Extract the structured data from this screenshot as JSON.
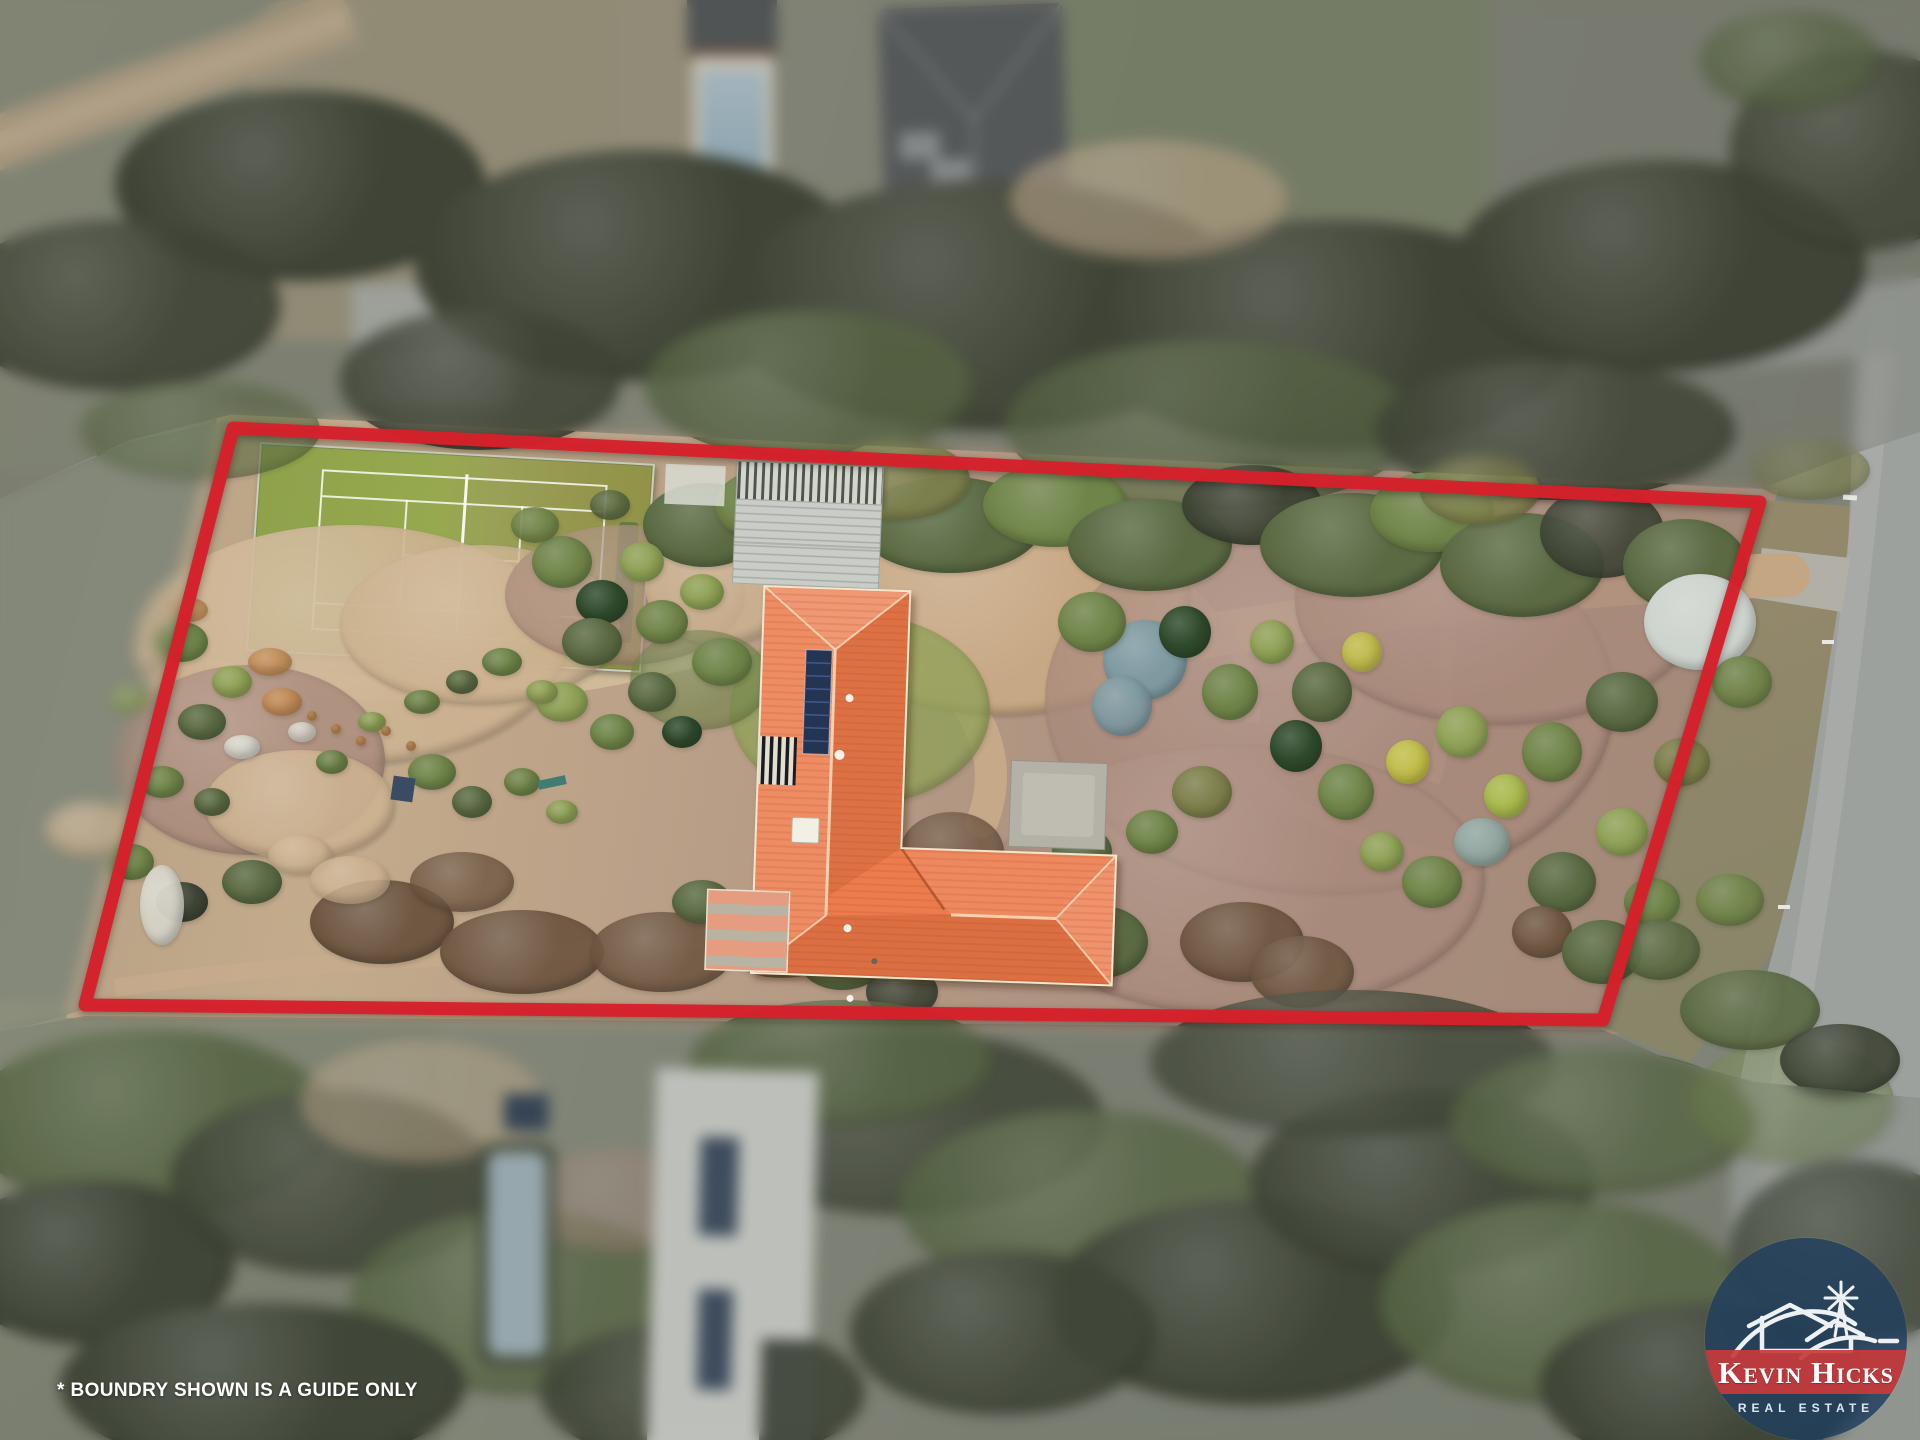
{
  "watermark": {
    "disclaimer": "* BOUNDRY SHOWN IS A GUIDE ONLY"
  },
  "logo": {
    "brand_top": "Kevin Hicks",
    "brand_bottom": "REAL ESTATE",
    "circle_color": "rgba(32,62,94,0.83)",
    "band_color": "rgba(200,58,60,0.92)"
  },
  "boundary": {
    "color": "#d6202a",
    "stroke_width": 13,
    "points": [
      [
        233,
        428
      ],
      [
        1760,
        502
      ],
      [
        1603,
        1020
      ],
      [
        85,
        1005
      ]
    ]
  },
  "scene": {
    "palette": [
      "#3f4536",
      "#5a6a43",
      "#6f8449",
      "#8fa156",
      "#7d7f4c",
      "#92a69f",
      "#7e99a0",
      "#c2bd4a",
      "#a9b94e",
      "#6f5742",
      "#cdb391",
      "#a98a7c",
      "#d6d3c8",
      "#c28a52",
      "#cdd3cd",
      "#2f4a2c",
      "#c7a884",
      "#b7bbb3"
    ],
    "blobs": [
      [
        350,
        645,
        215,
        120,
        10,
        0.9
      ],
      [
        250,
        760,
        135,
        95,
        11,
        0.8
      ],
      [
        300,
        805,
        95,
        55,
        10,
        0.9
      ],
      [
        480,
        625,
        140,
        80,
        10,
        0.8
      ],
      [
        625,
        595,
        120,
        70,
        11,
        0.7
      ],
      [
        720,
        585,
        75,
        60,
        10,
        0.85
      ],
      [
        1000,
        600,
        190,
        115,
        16,
        1
      ],
      [
        1330,
        700,
        285,
        195,
        11,
        0.75
      ],
      [
        1500,
        600,
        205,
        125,
        11,
        0.7
      ],
      [
        1240,
        880,
        245,
        135,
        11,
        0.7
      ],
      [
        860,
        710,
        130,
        95,
        3,
        0.75
      ],
      [
        700,
        680,
        70,
        50,
        2,
        0.6
      ],
      [
        90,
        830,
        45,
        28,
        10,
        0.85
      ],
      [
        300,
        855,
        32,
        20,
        10,
        0.9
      ],
      [
        300,
        185,
        185,
        95,
        0,
        1
      ],
      [
        640,
        265,
        225,
        115,
        0,
        1
      ],
      [
        990,
        305,
        265,
        125,
        0,
        1
      ],
      [
        1330,
        335,
        245,
        115,
        0,
        1
      ],
      [
        1660,
        265,
        205,
        105,
        0,
        1
      ],
      [
        115,
        305,
        165,
        85,
        0,
        0.9
      ],
      [
        810,
        385,
        165,
        75,
        1,
        0.8
      ],
      [
        1210,
        425,
        205,
        85,
        1,
        0.7
      ],
      [
        1555,
        430,
        180,
        70,
        0,
        0.85
      ],
      [
        480,
        380,
        140,
        70,
        0,
        0.85
      ],
      [
        200,
        430,
        120,
        50,
        1,
        0.6
      ],
      [
        1150,
        200,
        140,
        60,
        10,
        0.6
      ],
      [
        1860,
        150,
        130,
        100,
        0,
        0.85
      ],
      [
        1790,
        60,
        90,
        50,
        1,
        0.7
      ],
      [
        705,
        525,
        62,
        42,
        1,
        1
      ],
      [
        765,
        505,
        50,
        35,
        2,
        1
      ],
      [
        950,
        525,
        92,
        48,
        1,
        1
      ],
      [
        1055,
        505,
        72,
        42,
        2,
        1
      ],
      [
        1150,
        545,
        82,
        46,
        1,
        1
      ],
      [
        1252,
        505,
        70,
        40,
        0,
        0.95
      ],
      [
        1352,
        545,
        92,
        52,
        1,
        1
      ],
      [
        1432,
        512,
        62,
        40,
        2,
        1
      ],
      [
        1522,
        565,
        82,
        52,
        1,
        1
      ],
      [
        1602,
        532,
        62,
        46,
        0,
        0.9
      ],
      [
        1685,
        565,
        62,
        46,
        1,
        1
      ],
      [
        900,
        480,
        70,
        40,
        4,
        0.9
      ],
      [
        1480,
        490,
        60,
        35,
        4,
        0.85
      ],
      [
        1145,
        660,
        42,
        40,
        6,
        1
      ],
      [
        1122,
        706,
        30,
        30,
        6,
        0.95
      ],
      [
        1185,
        632,
        26,
        26,
        15,
        1
      ],
      [
        1092,
        622,
        34,
        30,
        2,
        1
      ],
      [
        1230,
        692,
        28,
        28,
        2,
        1
      ],
      [
        1272,
        642,
        22,
        22,
        3,
        1
      ],
      [
        1322,
        692,
        30,
        30,
        1,
        1
      ],
      [
        1362,
        652,
        20,
        20,
        7,
        0.95
      ],
      [
        1296,
        746,
        26,
        26,
        15,
        1
      ],
      [
        1346,
        792,
        28,
        28,
        2,
        1
      ],
      [
        1408,
        762,
        22,
        22,
        7,
        1
      ],
      [
        1462,
        732,
        26,
        26,
        3,
        1
      ],
      [
        1506,
        796,
        22,
        22,
        8,
        1
      ],
      [
        1552,
        752,
        30,
        30,
        2,
        1
      ],
      [
        1482,
        842,
        28,
        24,
        5,
        1
      ],
      [
        1432,
        882,
        30,
        26,
        2,
        1
      ],
      [
        1382,
        852,
        22,
        20,
        3,
        1
      ],
      [
        1562,
        882,
        34,
        30,
        1,
        1
      ],
      [
        1622,
        832,
        26,
        24,
        3,
        1
      ],
      [
        1542,
        932,
        30,
        26,
        9,
        0.95
      ],
      [
        1602,
        952,
        40,
        32,
        1,
        1
      ],
      [
        1652,
        902,
        28,
        24,
        2,
        1
      ],
      [
        1700,
        622,
        56,
        48,
        14,
        1
      ],
      [
        1742,
        682,
        30,
        26,
        2,
        0.95
      ],
      [
        1622,
        702,
        36,
        30,
        1,
        1
      ],
      [
        1682,
        762,
        28,
        24,
        4,
        1
      ],
      [
        1202,
        792,
        30,
        26,
        4,
        1
      ],
      [
        1152,
        832,
        26,
        22,
        2,
        1
      ],
      [
        1082,
        852,
        30,
        26,
        1,
        1
      ],
      [
        1242,
        942,
        62,
        40,
        9,
        0.95
      ],
      [
        1302,
        972,
        52,
        36,
        9,
        0.9
      ],
      [
        1102,
        942,
        46,
        36,
        1,
        1
      ],
      [
        1002,
        902,
        62,
        46,
        9,
        0.85
      ],
      [
        952,
        852,
        52,
        40,
        9,
        0.8
      ],
      [
        1660,
        950,
        40,
        30,
        1,
        0.9
      ],
      [
        1730,
        900,
        34,
        26,
        2,
        0.9
      ],
      [
        562,
        562,
        30,
        26,
        2,
        1
      ],
      [
        602,
        602,
        26,
        22,
        15,
        1
      ],
      [
        642,
        562,
        22,
        20,
        3,
        1
      ],
      [
        592,
        642,
        30,
        24,
        1,
        1
      ],
      [
        662,
        622,
        26,
        22,
        2,
        1
      ],
      [
        702,
        592,
        22,
        18,
        3,
        1
      ],
      [
        722,
        662,
        30,
        24,
        2,
        1
      ],
      [
        652,
        692,
        24,
        20,
        1,
        1
      ],
      [
        562,
        702,
        26,
        20,
        3,
        1
      ],
      [
        612,
        732,
        22,
        18,
        2,
        1
      ],
      [
        682,
        732,
        20,
        16,
        15,
        1
      ],
      [
        535,
        525,
        24,
        18,
        2,
        0.9
      ],
      [
        610,
        505,
        20,
        15,
        1,
        0.9
      ],
      [
        182,
        642,
        26,
        20,
        2,
        1
      ],
      [
        232,
        682,
        20,
        16,
        3,
        1
      ],
      [
        202,
        722,
        24,
        18,
        1,
        1
      ],
      [
        282,
        702,
        20,
        14,
        13,
        0.9
      ],
      [
        270,
        662,
        22,
        14,
        13,
        0.85
      ],
      [
        190,
        610,
        18,
        12,
        13,
        0.8
      ],
      [
        242,
        747,
        18,
        12,
        12,
        1
      ],
      [
        302,
        732,
        14,
        10,
        12,
        0.95
      ],
      [
        162,
        782,
        22,
        16,
        2,
        1
      ],
      [
        212,
        802,
        18,
        14,
        1,
        1
      ],
      [
        332,
        762,
        16,
        12,
        2,
        1
      ],
      [
        372,
        722,
        14,
        10,
        3,
        1
      ],
      [
        422,
        702,
        18,
        12,
        2,
        1
      ],
      [
        462,
        682,
        16,
        12,
        1,
        1
      ],
      [
        502,
        662,
        20,
        14,
        2,
        1
      ],
      [
        542,
        692,
        16,
        12,
        3,
        1
      ],
      [
        312,
        716,
        5,
        5,
        13,
        1
      ],
      [
        336,
        729,
        5,
        5,
        13,
        1
      ],
      [
        361,
        741,
        5,
        5,
        13,
        1
      ],
      [
        386,
        731,
        5,
        5,
        13,
        1
      ],
      [
        411,
        746,
        5,
        5,
        13,
        1
      ],
      [
        432,
        772,
        24,
        18,
        2,
        1
      ],
      [
        472,
        802,
        20,
        16,
        1,
        1
      ],
      [
        522,
        782,
        18,
        14,
        2,
        1
      ],
      [
        562,
        812,
        16,
        12,
        3,
        1
      ],
      [
        130,
        700,
        20,
        14,
        3,
        0.8
      ],
      [
        150,
        660,
        16,
        10,
        10,
        0.9
      ],
      [
        382,
        922,
        72,
        42,
        9,
        1
      ],
      [
        522,
        952,
        82,
        42,
        9,
        0.95
      ],
      [
        662,
        952,
        72,
        40,
        9,
        0.9
      ],
      [
        782,
        942,
        62,
        36,
        9,
        0.85
      ],
      [
        462,
        882,
        52,
        30,
        9,
        0.8
      ],
      [
        252,
        882,
        30,
        22,
        1,
        1
      ],
      [
        182,
        902,
        26,
        20,
        0,
        1
      ],
      [
        132,
        862,
        22,
        18,
        2,
        1
      ],
      [
        702,
        902,
        30,
        22,
        1,
        1
      ],
      [
        842,
        962,
        42,
        28,
        1,
        1
      ],
      [
        902,
        992,
        36,
        26,
        0,
        0.9
      ],
      [
        162,
        905,
        22,
        40,
        12,
        0.95
      ],
      [
        350,
        880,
        40,
        24,
        10,
        0.8
      ],
      [
        152,
        1122,
        182,
        92,
        1,
        0.9
      ],
      [
        92,
        1262,
        142,
        82,
        0,
        1
      ],
      [
        332,
        1182,
        162,
        92,
        0,
        0.85
      ],
      [
        522,
        1302,
        172,
        92,
        1,
        0.8
      ],
      [
        262,
        1385,
        202,
        82,
        0,
        1
      ],
      [
        702,
        1392,
        162,
        72,
        0,
        0.9
      ],
      [
        902,
        1122,
        202,
        92,
        0,
        0.85
      ],
      [
        1082,
        1202,
        182,
        92,
        1,
        0.8
      ],
      [
        1252,
        1302,
        202,
        102,
        0,
        1
      ],
      [
        1422,
        1182,
        172,
        92,
        0,
        0.9
      ],
      [
        1562,
        1302,
        182,
        102,
        1,
        0.85
      ],
      [
        1702,
        1385,
        162,
        82,
        0,
        1
      ],
      [
        1852,
        1252,
        122,
        92,
        0,
        0.8
      ],
      [
        1002,
        1332,
        152,
        82,
        0,
        0.9
      ],
      [
        842,
        1062,
        152,
        62,
        1,
        0.8
      ],
      [
        1352,
        1062,
        202,
        72,
        0,
        0.75
      ],
      [
        1602,
        1122,
        152,
        72,
        1,
        0.8
      ],
      [
        422,
        1102,
        122,
        62,
        10,
        0.5
      ],
      [
        622,
        1202,
        102,
        52,
        11,
        0.5
      ],
      [
        1792,
        1102,
        102,
        62,
        2,
        0.5
      ],
      [
        1810,
        470,
        60,
        30,
        4,
        0.6
      ],
      [
        1750,
        1010,
        70,
        40,
        1,
        0.9
      ],
      [
        1840,
        1060,
        60,
        36,
        0,
        0.9
      ]
    ]
  }
}
